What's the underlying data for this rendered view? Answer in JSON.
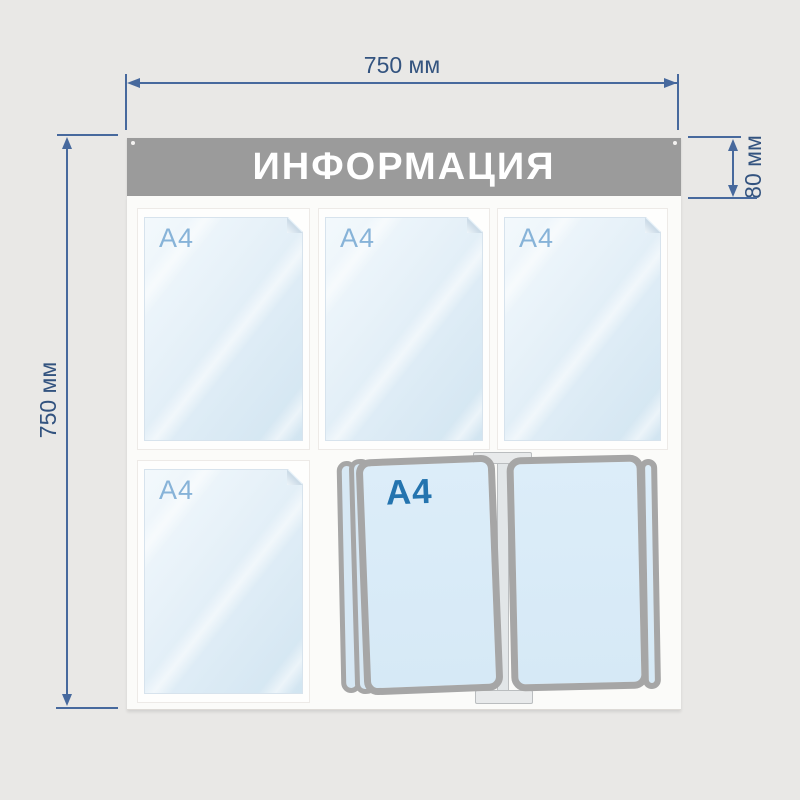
{
  "stand": {
    "title": "ИНФОРМАЦИЯ",
    "pockets": [
      {
        "label": "A4"
      },
      {
        "label": "A4"
      },
      {
        "label": "A4"
      },
      {
        "label": "A4"
      }
    ],
    "flip_pocket": {
      "label": "A4"
    }
  },
  "dimensions": {
    "width": "750 мм",
    "height": "750 мм",
    "header_height": "80 мм"
  },
  "colors": {
    "background": "#e9e8e6",
    "dimension_line": "#47699d",
    "dimension_text": "#33537f",
    "header_bg": "#9b9b9b",
    "header_text": "#ffffff",
    "board_bg": "#fbfbf9",
    "pocket_fill": "#ddecf6",
    "pocket_label": "#87b3d8",
    "flip_frame": "#a6a6a6",
    "flip_label": "#2474af"
  }
}
